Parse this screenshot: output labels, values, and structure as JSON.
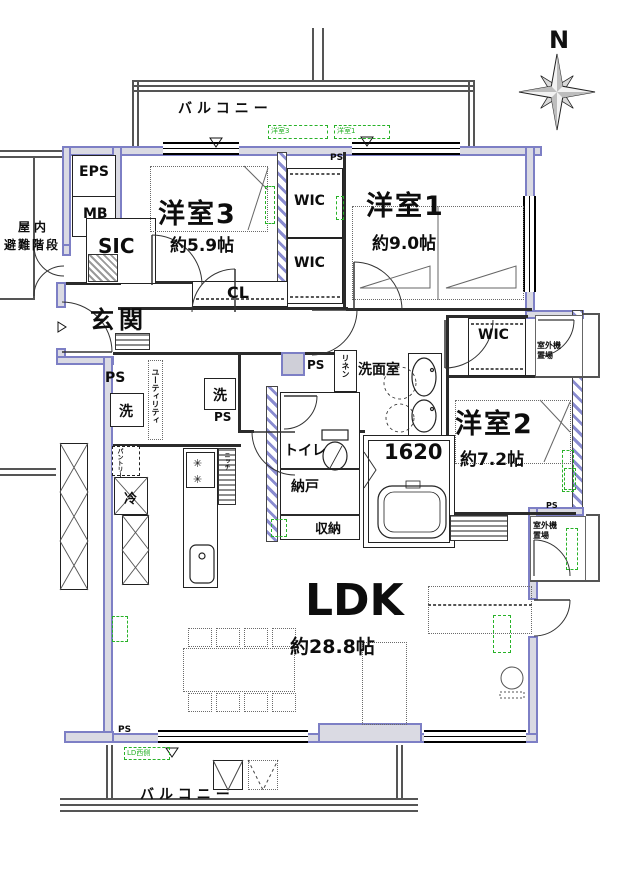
{
  "compass": {
    "north": "N"
  },
  "labels": {
    "balcony": "バルコニー",
    "room3_name": "洋室3",
    "room3_size": "約5.9帖",
    "room1_name": "洋室1",
    "room1_size": "約9.0帖",
    "room2_name": "洋室2",
    "room2_size": "約7.2帖",
    "ldk_name": "LDK",
    "ldk_size": "約28.8帖",
    "genkan": "玄関",
    "sic": "SIC",
    "cl": "CL",
    "wic": "WIC",
    "eps": "EPS",
    "mb": "MB",
    "stairs1": "屋内",
    "stairs2": "避難階段",
    "ps": "PS",
    "wash": "洗",
    "fridge": "冷",
    "linen": "リネン",
    "utility": "ユーティリティ",
    "pantry": "パントリー",
    "niche": "ニッチ",
    "senmen": "洗面室",
    "toilet": "トイレ",
    "bath_size": "1620",
    "nando": "納戸",
    "shuno": "収納",
    "outdoor1": "室外機",
    "outdoor2": "置場",
    "tag_room3": "洋室3",
    "tag_room1": "洋室1",
    "tag_ld": "LD西側"
  },
  "colors": {
    "wall": "#7d7fc5",
    "wall_fill": "#dadae3",
    "annotation": "#28b228"
  }
}
